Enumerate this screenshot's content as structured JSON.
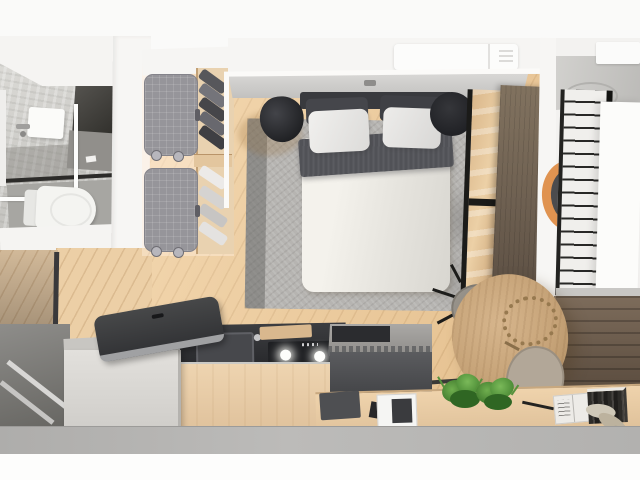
{
  "image": {
    "kind": "photorealistic 3d render",
    "subject": "studio apartment floor plan viewed from directly above",
    "width_px": 640,
    "height_px": 480,
    "background": "#fafaf9"
  },
  "palette": {
    "margin_white": "#fbfbfa",
    "wall_white": "#f6f5f3",
    "wood_floor": "#ecca9b",
    "wood_floor_light": "#f0d8bb",
    "wood_counter": "#e9d0aa",
    "dark_wood_wall": "#61523f",
    "door_wood": "#6e6051",
    "rug_gray": "#b6b4b1",
    "bed_duvet": "#ece9e3",
    "bed_blanket": "#515257",
    "stool_black": "#232427",
    "counter_dark": "#2b2c2f",
    "island_gray": "#5b5c5f",
    "cabinet_gray": "#d9d7d3",
    "bath_tile": "#d8d7d3",
    "concrete_floor": "#b4b3b1",
    "plant_green": "#4c8c36",
    "accent_orange": "#e09350"
  },
  "rooms": {
    "bathroom": {
      "floor_color": "#d8d7d3",
      "fixtures": [
        {
          "name": "toilet",
          "color": "#f4f4f1"
        },
        {
          "name": "wall-hung-sink",
          "color": "#fbfbf9"
        },
        {
          "name": "vanity-cabinet",
          "color": "#3e3c38"
        },
        {
          "name": "glass-shower-partition",
          "color": "#fdfdfc"
        }
      ]
    },
    "closet": {
      "floor_color": "#f0d8bb",
      "items": [
        {
          "name": "upholstered-storage-unit-top",
          "color": "#96959a"
        },
        {
          "name": "upholstered-storage-unit-bottom",
          "color": "#96959a"
        },
        {
          "name": "dark-folded-clothes-shelf",
          "color": "#57575b"
        },
        {
          "name": "light-folded-clothes-shelf",
          "color": "#e4e2e0"
        }
      ]
    },
    "bedroom": {
      "floor_color": "#ecca9b",
      "items": [
        {
          "name": "double-bed",
          "duvet": "#ece9e3",
          "blanket": "#515257",
          "pillows_white": "#edecea",
          "pillows_dark": "#45464b",
          "headboard": "#393a3e"
        },
        {
          "name": "area-rug",
          "color": "#b6b4b1"
        },
        {
          "name": "round-stool-left",
          "color": "#232427"
        },
        {
          "name": "round-stool-right",
          "color": "#232427"
        },
        {
          "name": "air-conditioner",
          "color": "#fcfcfb"
        },
        {
          "name": "glazed-wall",
          "frame": "#1b1b19"
        },
        {
          "name": "wood-sliding-door",
          "color": "#6e6051"
        }
      ]
    },
    "kitchen": {
      "items": [
        {
          "name": "dark-countertop-with-sink-and-hob",
          "color": "#2b2c2f"
        },
        {
          "name": "wood-counter-front",
          "color": "#e9d0aa"
        },
        {
          "name": "gray-base-cabinet",
          "color": "#d9d7d3"
        },
        {
          "name": "dark-cover-tray",
          "color": "#3a3b3e"
        },
        {
          "name": "dark-island-unit",
          "color": "#5b5c5f"
        }
      ]
    },
    "dining_corner": {
      "items": [
        {
          "name": "round-wood-table",
          "color": "#c6a378"
        },
        {
          "name": "twig-wreath-decor",
          "color": "#97794f"
        },
        {
          "name": "gray-chair",
          "color": "#97928a"
        },
        {
          "name": "taupe-chair",
          "color": "#b2a798"
        }
      ]
    },
    "window_ledge": {
      "items": [
        {
          "name": "dark-mat",
          "color": "#4e4f52"
        },
        {
          "name": "white-tray-with-dark-object",
          "color": "#f5f5f3"
        },
        {
          "name": "potted-plant-1",
          "color": "#4c8c36"
        },
        {
          "name": "potted-plant-2",
          "color": "#4c8c36"
        },
        {
          "name": "open-book",
          "color": "#edebe7"
        },
        {
          "name": "book-row",
          "color": "#2d2b28"
        },
        {
          "name": "dried-flowers",
          "color": "#bcb29e"
        }
      ]
    },
    "adjacent_room_right": {
      "items": [
        {
          "name": "ladder-window-grille",
          "frame": "#232321"
        },
        {
          "name": "white-wall-panel",
          "color": "#fcfcfa"
        },
        {
          "name": "orange-round-chair",
          "color": "#e09350"
        },
        {
          "name": "ceiling-unit",
          "color": "#fbfbfa"
        }
      ]
    },
    "entry": {
      "items": [
        {
          "name": "gray-entry-floor",
          "color": "#7b7a78"
        },
        {
          "name": "metal-threshold-strips",
          "color": "#d8d7d5"
        },
        {
          "name": "dark-partition-track",
          "color": "#3a393b"
        }
      ]
    }
  }
}
